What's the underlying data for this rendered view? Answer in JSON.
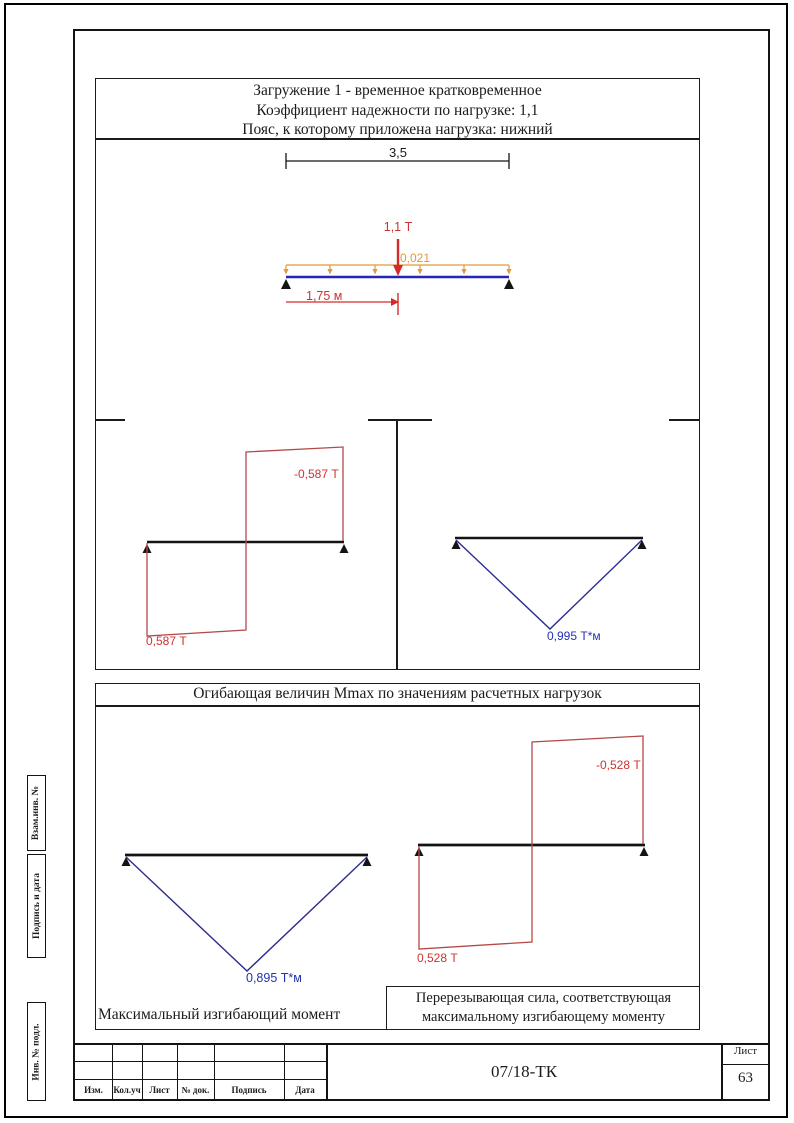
{
  "document": {
    "load_case": {
      "title_line1": "Загружение 1 - временное кратковременное",
      "title_line2": "Коэффициент надежности по нагрузке: 1,1",
      "title_line3": "Пояс, к которому приложена нагрузка: нижний"
    },
    "beam_figure": {
      "span": "3,5",
      "point_load": "1,1 Т",
      "distributed_load": "0,021",
      "load_position": "1,75 м"
    },
    "shear_diagram_1": {
      "negative": "-0,587 Т",
      "positive": "0,587 Т"
    },
    "moment_diagram_1": {
      "max": "0,995 Т*м"
    },
    "envelope": {
      "title": "Огибающая величин Mmax по значениям расчетных нагрузок",
      "moment_diagram": {
        "max": "0,895 Т*м",
        "caption": "Максимальный изгибающий момент"
      },
      "shear_diagram": {
        "negative": "-0,528 Т",
        "positive": "0,528 Т",
        "caption_line1": "Перерезывающая сила, соответствующая",
        "caption_line2": "максимальному изгибающему моменту"
      }
    },
    "side_stamp": {
      "items": [
        "Взам.инв. №",
        "Подпись и дата",
        "Инв. № подл."
      ]
    },
    "title_block": {
      "columns": [
        "Изм.",
        "Кол.уч",
        "Лист",
        "№ док.",
        "Подпись",
        "Дата"
      ],
      "doc_number": "07/18-ТК",
      "sheet_label": "Лист",
      "sheet_number": "63"
    }
  },
  "colors": {
    "red_label": "#cc3333",
    "blue_label": "#2233b0",
    "orange_label": "#e09a3c",
    "line": "#1b1b1b",
    "beam_blue": "#2424bd",
    "diagram_red": "#b54848",
    "diagram_blue": "#2a2d8f",
    "load_red": "#d42a2a"
  }
}
